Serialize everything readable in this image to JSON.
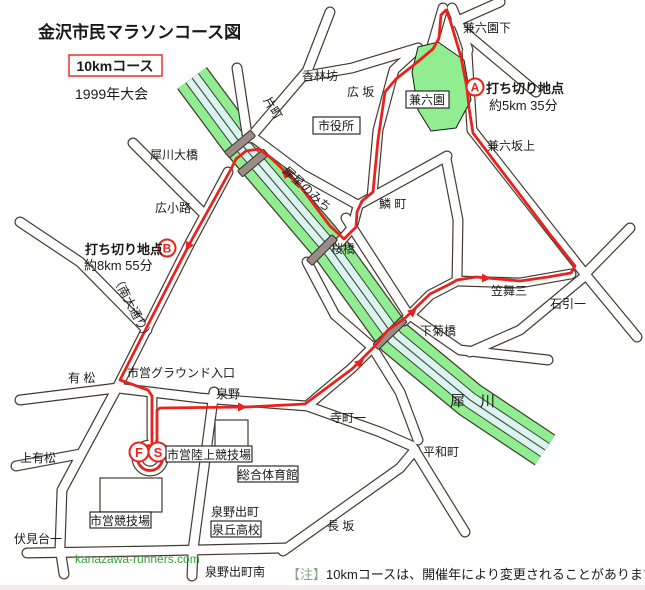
{
  "map": {
    "title": "金沢市民マラソンコース図",
    "course_badge": "10kmコース",
    "year": "1999年大会",
    "watermark": "kanazawa-runners.com",
    "note": {
      "prefix": "【注】",
      "text": "10kmコースは、開催年により変更されることがあります。"
    },
    "checkpoints": {
      "a": {
        "letter": "A",
        "label": "打ち切り地点",
        "detail": "約5km 35分"
      },
      "b": {
        "letter": "B",
        "label": "打ち切り地点",
        "detail": "約8km 55分"
      },
      "finish_letter": "F",
      "start_letter": "S"
    },
    "places": {
      "kenrokuen_shita": "兼六園下",
      "korinbo": "香林坊",
      "hirosaka": "広 坂",
      "katamachi": "片町",
      "shiyakusho": "市役所",
      "kenrokuen": "兼六園",
      "kenroku_sakaue": "兼六坂上",
      "saigawa_ohashi": "犀川大橋",
      "saisei_no_michi": "犀星のみち",
      "urokomachi": "鱗 町",
      "hirokoji": "広小路",
      "sakurabashi": "桜橋",
      "minami_odori": "（南大通り）",
      "kasamai_san": "笠舞三",
      "ishibiki_ichi": "石引一",
      "shimokikubashi": "下菊橋",
      "shiei_ground_entrance": "市営グラウンド入口",
      "arimatsu": "有 松",
      "izumino": "泉野",
      "teramachi_ichi": "寺町一",
      "heiwamachi": "平和町",
      "saigawa_river": "犀　川",
      "shiei_rikujo_stadium": "市営陸上競技場",
      "sogo_gym": "総合体育館",
      "kami_arimatsu": "上有松",
      "shiei_stadium": "市営競技場",
      "izumino_demachi": "泉野出町",
      "izumigaoka_hs": "泉丘高校",
      "nagasaka": "長 坂",
      "fushimidai_ichi": "伏見台一",
      "izumino_demachi_minami": "泉野出町南"
    },
    "colors": {
      "route_red": "#e8231e",
      "river_green": "#90ee90",
      "river_water": "#d8f5f0",
      "park_green": "#90ee90",
      "road_fill": "#ffffff",
      "road_outline": "#453a32",
      "watermark_green": "#3a9e3a",
      "note_prefix_green": "#8aa08a",
      "background": "#ffffff"
    }
  }
}
